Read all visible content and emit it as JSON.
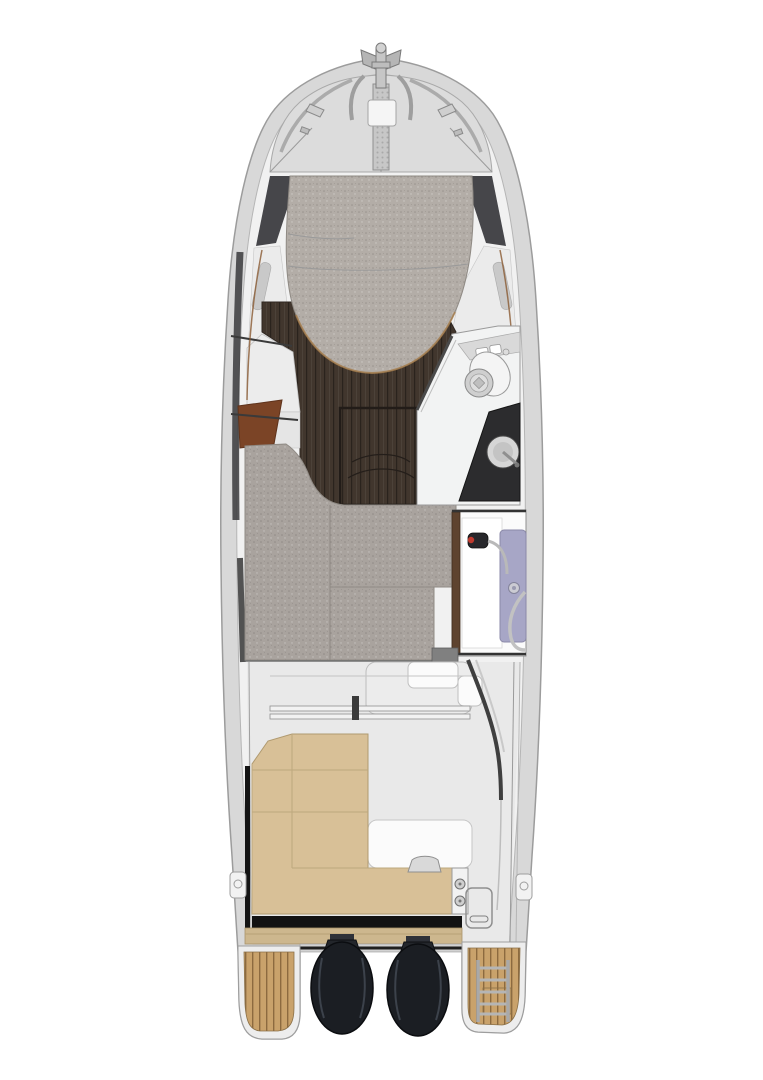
{
  "page": {
    "background": "#ffffff"
  },
  "image": {
    "subject": "Top-down deck and interior layout plan of a motor cruiser, bow up, with twin outboard engines at the stern",
    "view": "overhead plan"
  },
  "features": {
    "engines": 2,
    "swim_platforms": 2,
    "boarding_ladder": 1,
    "berth_cushions": 2,
    "toilet": 1,
    "sink": 1,
    "shower": 1,
    "cockpit_bench": "L-shaped",
    "anchor_fitting": 1,
    "foredeck_hatch": 1
  },
  "colors": {
    "background": "#ffffff",
    "hull_rim": "#d8d8d8",
    "hull_inner": "#f1f1f1",
    "deck_panel": "#dcdcdc",
    "shadow_dark": "#46464a",
    "side_panel": "#ebebeb",
    "berth_cushion": "#b3ada7",
    "mid_cushion": "#a9a39e",
    "wood_floor": "#41362d",
    "wood_trim": "#a97c44",
    "rust_panel": "#7b4426",
    "head_floor": "#f2f3f3",
    "counter_top": "#2c2c2e",
    "fixture_metal": "#cfcfcf",
    "shower_panel": "#a7a6c6",
    "shower_head": "#27272b",
    "shower_red": "#c03a2e",
    "cockpit_floor": "#e9e9e9",
    "bench_cushion": "#d8c097",
    "shadow_strip": "#121212",
    "step_tan": "#cdb78e",
    "teak": "#c9a26b",
    "platform": "#ededed",
    "engine": "#1b1e23",
    "engine_highlight": "#3c424b",
    "white_panel": "#fbfbfb",
    "metal": "#a9a9a9",
    "transom": "#d2d2d2"
  }
}
